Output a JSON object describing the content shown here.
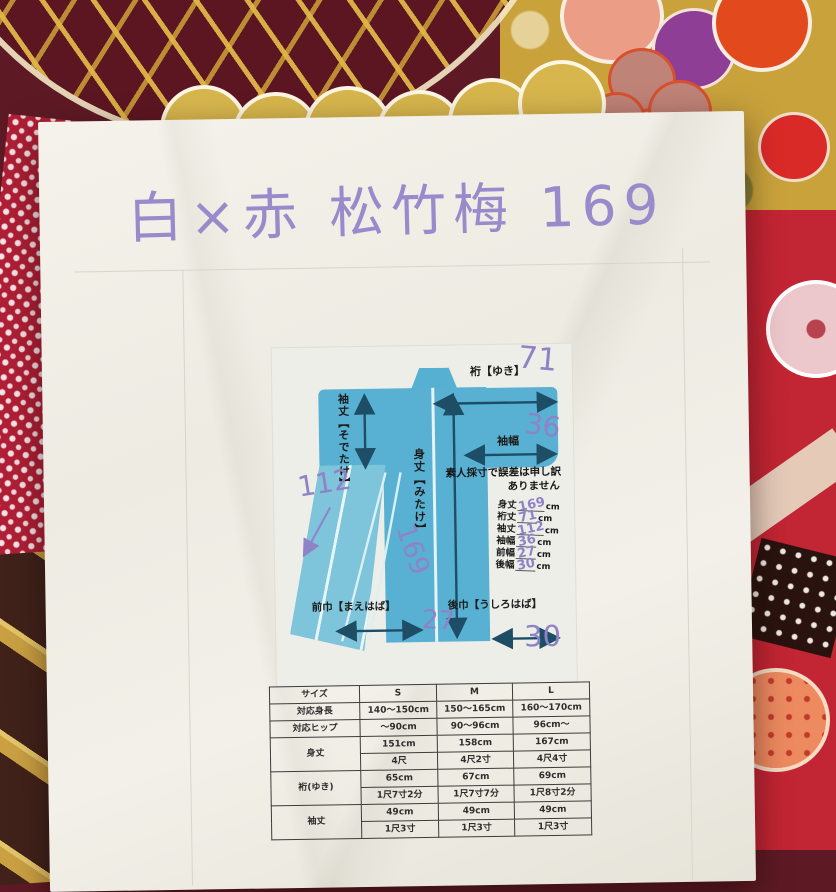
{
  "note": {
    "handwritten_title": "白×赤 松竹梅 169"
  },
  "diagram": {
    "yuki_label": "裄【ゆき】",
    "yuki_value": "71",
    "sodehaba_label": "袖幅",
    "sodehaba_value": "36",
    "sodetake_label": "袖丈【そでたけ】",
    "sodetake_value": "112",
    "mitake_label": "身丈【みたけ】",
    "mitake_value": "169",
    "maehaba_label": "前巾【まえはば】",
    "maehaba_value": "27",
    "ushirohaba_label": "後巾【うしろはば】",
    "ushirohaba_value": "30",
    "disclaimer_line1": "素人採寸で誤差は申し訳",
    "disclaimer_line2": "ありません",
    "measures": [
      {
        "label": "身丈",
        "value": "169",
        "unit": "cm"
      },
      {
        "label": "裄丈",
        "value": "71",
        "unit": "cm"
      },
      {
        "label": "袖丈",
        "value": "112",
        "unit": "cm"
      },
      {
        "label": "袖幅",
        "value": "36",
        "unit": "cm"
      },
      {
        "label": "前幅",
        "value": "27",
        "unit": "cm"
      },
      {
        "label": "後幅",
        "value": "30",
        "unit": "cm"
      }
    ]
  },
  "size_table": {
    "headers": [
      "サイズ",
      "S",
      "M",
      "L"
    ],
    "rows": [
      {
        "label": "対応身長",
        "cells": [
          "140～150cm",
          "150～165cm",
          "160～170cm"
        ]
      },
      {
        "label": "対応ヒップ",
        "cells": [
          "～90cm",
          "90～96cm",
          "96cm～"
        ]
      },
      {
        "label": "身丈",
        "cells": [
          "151cm",
          "158cm",
          "167cm"
        ]
      },
      {
        "label": "",
        "cells": [
          "4尺",
          "4尺2寸",
          "4尺4寸"
        ]
      },
      {
        "label": "裄(ゆき)",
        "cells": [
          "65cm",
          "67cm",
          "69cm"
        ]
      },
      {
        "label": "",
        "cells": [
          "1尺7寸2分",
          "1尺7寸7分",
          "1尺8寸2分"
        ]
      },
      {
        "label": "袖丈",
        "cells": [
          "49cm",
          "49cm",
          "49cm"
        ]
      },
      {
        "label": "",
        "cells": [
          "1尺3寸",
          "1尺3寸",
          "1尺3寸"
        ]
      }
    ]
  },
  "colors": {
    "kimono_blue": "#58b1d3",
    "handwriting_purple": "#8f82c6",
    "arrow_navy": "#1e4d66"
  }
}
